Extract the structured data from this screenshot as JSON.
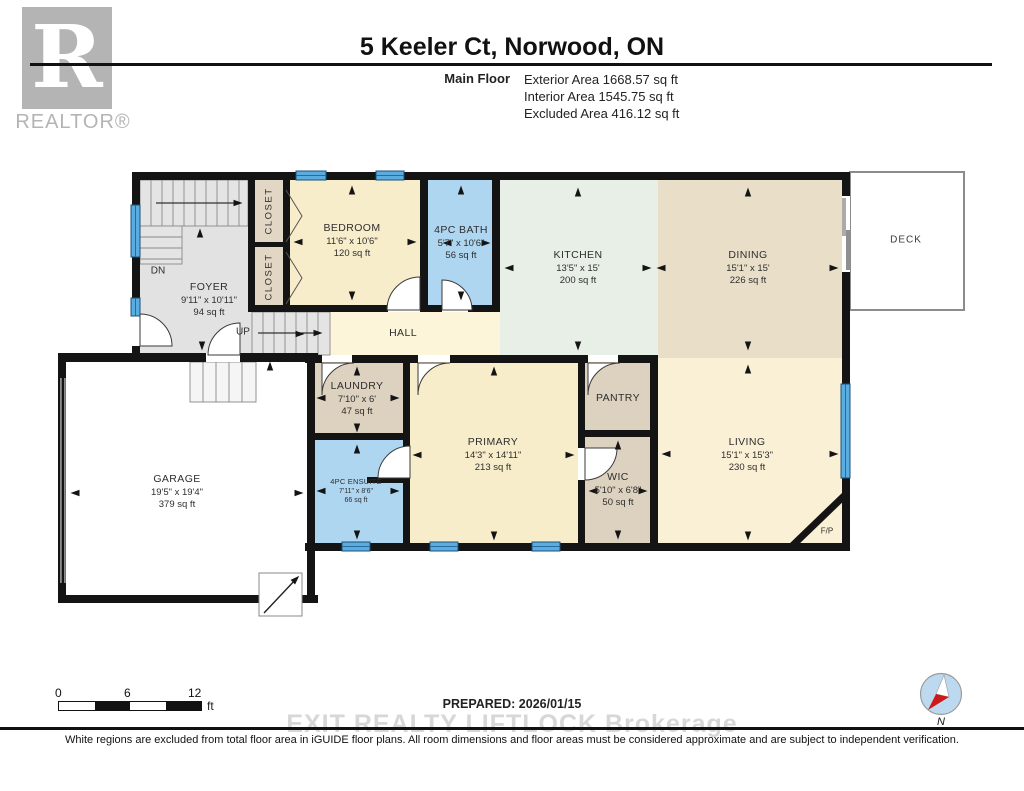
{
  "logo": {
    "letter": "R",
    "brand": "REALTOR®"
  },
  "header": {
    "title": "5 Keeler Ct, Norwood, ON",
    "floor_label": "Main Floor",
    "stats": [
      {
        "label": "Exterior Area",
        "value": "1668.57 sq ft"
      },
      {
        "label": "Interior Area",
        "value": "1545.75 sq ft"
      },
      {
        "label": "Excluded Area",
        "value": "416.12 sq ft"
      }
    ]
  },
  "rooms": {
    "foyer": {
      "name": "FOYER",
      "dims": "9'11\" x 10'11\"",
      "area": "94 sq ft"
    },
    "closet_upper": {
      "name": "CLOSET"
    },
    "closet_lower": {
      "name": "CLOSET"
    },
    "bedroom": {
      "name": "BEDROOM",
      "dims": "11'6\" x 10'6\"",
      "area": "120 sq ft"
    },
    "bath": {
      "name": "4PC BATH",
      "dims": "5'7\" x 10'6\"",
      "area": "56 sq ft"
    },
    "kitchen": {
      "name": "KITCHEN",
      "dims": "13'5\" x 15'",
      "area": "200 sq ft"
    },
    "dining": {
      "name": "DINING",
      "dims": "15'1\" x 15'",
      "area": "226 sq ft"
    },
    "deck": {
      "name": "DECK"
    },
    "hall": {
      "name": "HALL"
    },
    "laundry": {
      "name": "LAUNDRY",
      "dims": "7'10\" x 6'",
      "area": "47 sq ft"
    },
    "pantry": {
      "name": "PANTRY"
    },
    "primary": {
      "name": "PRIMARY",
      "dims": "14'3\" x 14'11\"",
      "area": "213 sq ft"
    },
    "wic": {
      "name": "WIC",
      "dims": "5'10\" x 6'8\"",
      "area": "50 sq ft"
    },
    "living": {
      "name": "LIVING",
      "dims": "15'1\" x 15'3\"",
      "area": "230 sq ft"
    },
    "ensuite": {
      "name": "4PC ENSUITE",
      "dims": "7'11\" x 8'6\"",
      "area": "66 sq ft"
    },
    "garage": {
      "name": "GARAGE",
      "dims": "19'5\" x 19'4\"",
      "area": "379 sq ft"
    },
    "fireplace": {
      "name": "F/P"
    }
  },
  "plan_labels": {
    "dn": "DN",
    "up": "UP"
  },
  "scale_bar": {
    "t0": "0",
    "t6": "6",
    "t12": "12",
    "unit": "ft"
  },
  "compass": {
    "north": "N"
  },
  "footer": {
    "prepared": "PREPARED: 2026/01/15",
    "watermark": "EXIT REALTY LIFTLOCK Brokerage",
    "disclaimer": "White regions are excluded from total floor area in iGUIDE floor plans. All room dimensions and floor areas must be considered approximate and are subject to independent verification."
  },
  "colors": {
    "wall": "#141414",
    "window": "#5aade0",
    "bath_blue": "#aed6f1",
    "bedroom_cream": "#f8edca",
    "hall_cream": "#fcf5da",
    "living_cream": "#faf0d6",
    "kitchen_mint": "#e8efe7",
    "dining_tan": "#e9dfc9",
    "closet_tan": "#e2d7c4",
    "foyer_gray": "#e2e2e2",
    "compass_red": "#cc1a1a",
    "watermark_gray": "#d7d7d7"
  }
}
